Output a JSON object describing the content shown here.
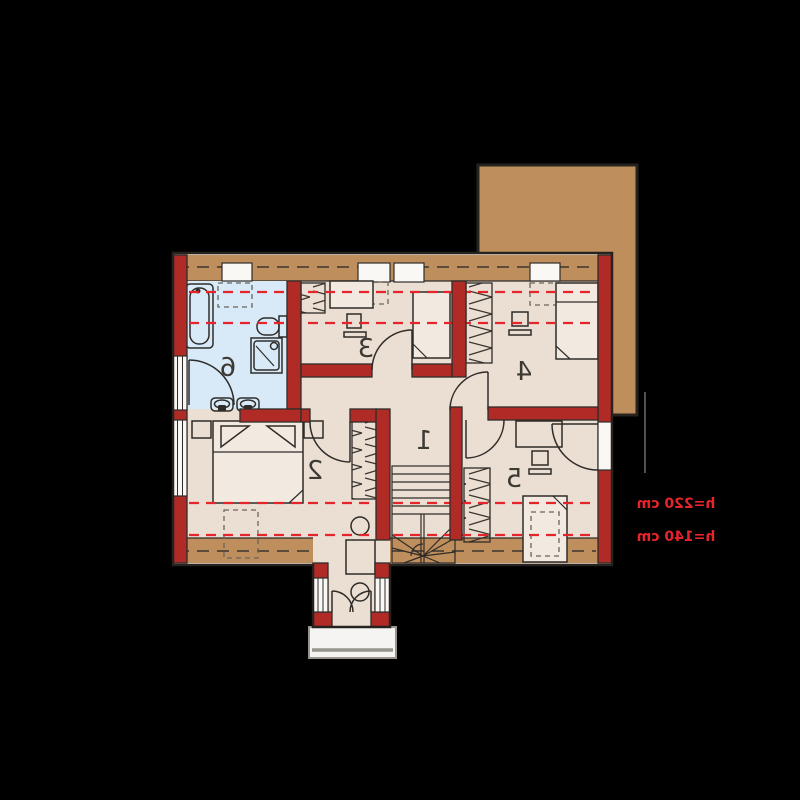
{
  "colors": {
    "bg": "#000000",
    "wall": "#B12B26",
    "roof": "#BE8E5D",
    "interior": "#EBDFD3",
    "bath": "#D8EAF7",
    "line": "#2F2C29",
    "accent": "#E7242B",
    "furnfill": "#F2EAE1",
    "recess": "#FAF8F5",
    "balcony": "#F5F4F2"
  },
  "plan": {
    "type": "attic-floor-plan",
    "mirrored": true,
    "rooms": [
      {
        "number": "1"
      },
      {
        "number": "2"
      },
      {
        "number": "3"
      },
      {
        "number": "4"
      },
      {
        "number": "5"
      },
      {
        "number": "6"
      }
    ],
    "height_annotations": [
      {
        "text": "h=220 cm"
      },
      {
        "text": "h=140 cm"
      }
    ]
  }
}
